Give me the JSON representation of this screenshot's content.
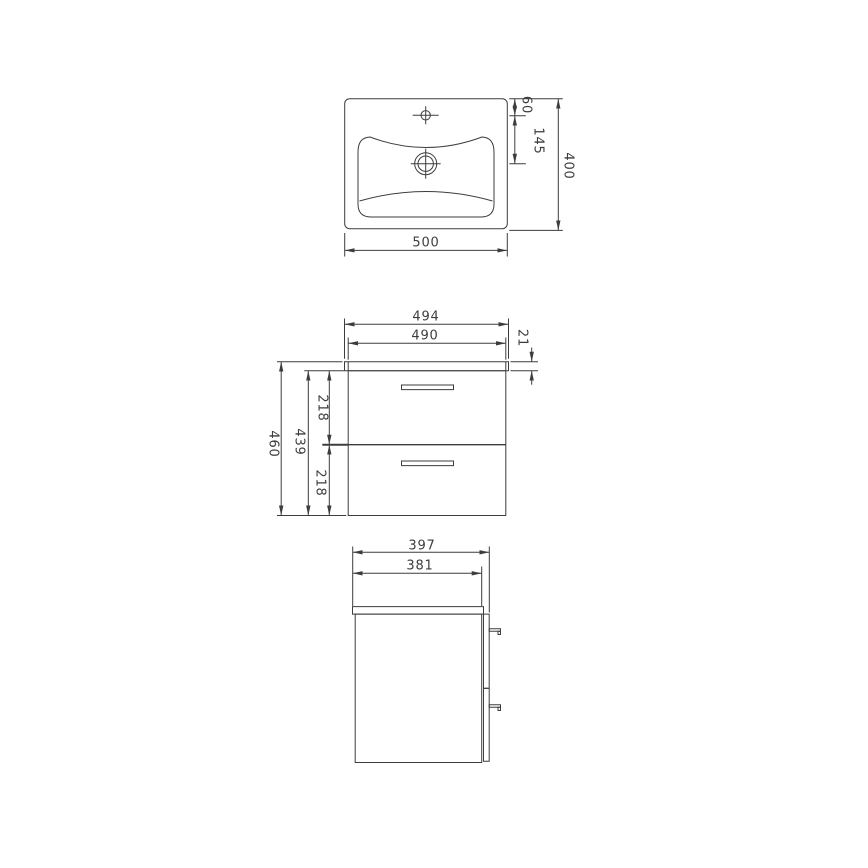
{
  "drawing": {
    "type": "technical-dimension-drawing",
    "subject": "washbasin and two-drawer vanity cabinet"
  },
  "views": {
    "basin_top": {
      "name": "washbasin top view",
      "dims": {
        "width": "500",
        "depth": "400",
        "tap_hole_offset": "60",
        "tap_to_drain": "145"
      }
    },
    "cabinet_front": {
      "name": "cabinet front view",
      "dims": {
        "top_panel_width": "494",
        "body_width": "490",
        "top_panel_thickness": "21",
        "total_height": "460",
        "body_height": "439",
        "upper_drawer_height": "218",
        "lower_drawer_height": "218"
      }
    },
    "cabinet_side": {
      "name": "cabinet side view",
      "dims": {
        "total_depth": "397",
        "body_depth": "381"
      }
    }
  },
  "colors": {
    "line": "#3d3d3d",
    "text": "#3d3d3d",
    "background": "#ffffff"
  }
}
